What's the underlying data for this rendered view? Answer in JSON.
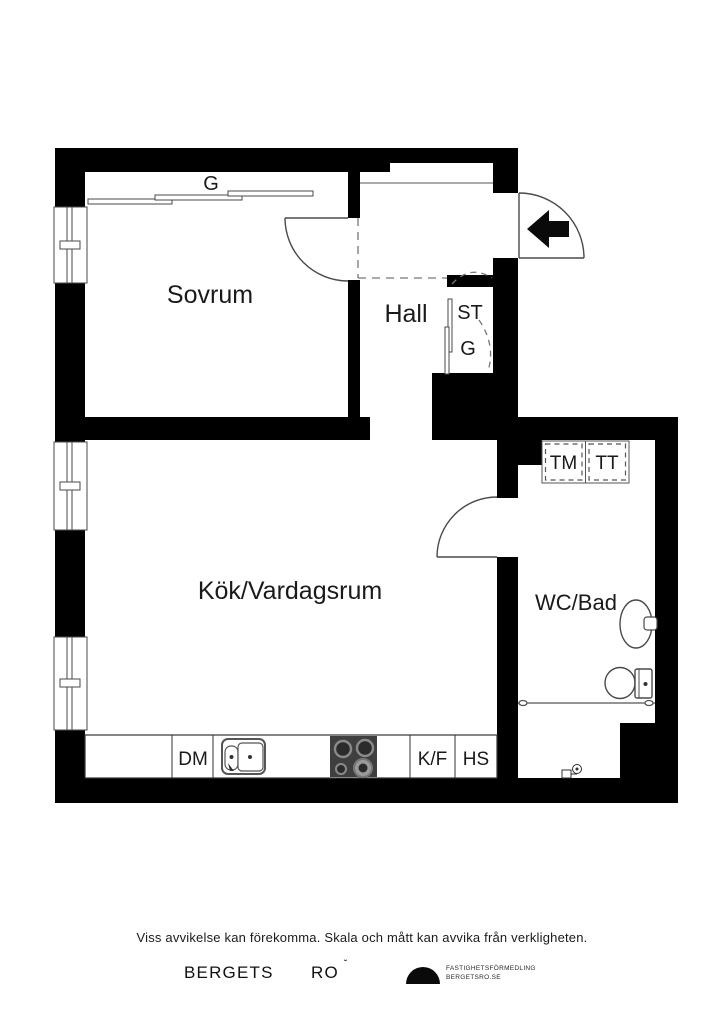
{
  "plan": {
    "rooms": {
      "bedroom": "Sovrum",
      "hall": "Hall",
      "kitchen_living": "Kök/Vardagsrum",
      "bathroom": "WC/Bad"
    },
    "closets": {
      "bedroom_wardrobe": "G",
      "cleaning_closet": "ST",
      "hall_wardrobe": "G"
    },
    "appliances": {
      "washing_machine": "TM",
      "tumble_dryer": "TT",
      "dishwasher": "DM",
      "fridge_freezer": "K/F",
      "tall_cabinet": "HS"
    }
  },
  "footer": {
    "disclaimer": "Viss avvikelse kan förekomma. Skala och mått kan avvika från verkligheten.",
    "brand_word1": "BERGETS",
    "brand_word2": "RO",
    "brand_mark": "˘",
    "agency_line1": "FASTIGHETSFÖRMEDLING",
    "agency_line2": "BERGETSRO.SE"
  },
  "colors": {
    "wall": "#000000",
    "line": "#4a4a4a",
    "dash": "#777777",
    "stove": "#3f3f3f",
    "background": "#ffffff"
  }
}
